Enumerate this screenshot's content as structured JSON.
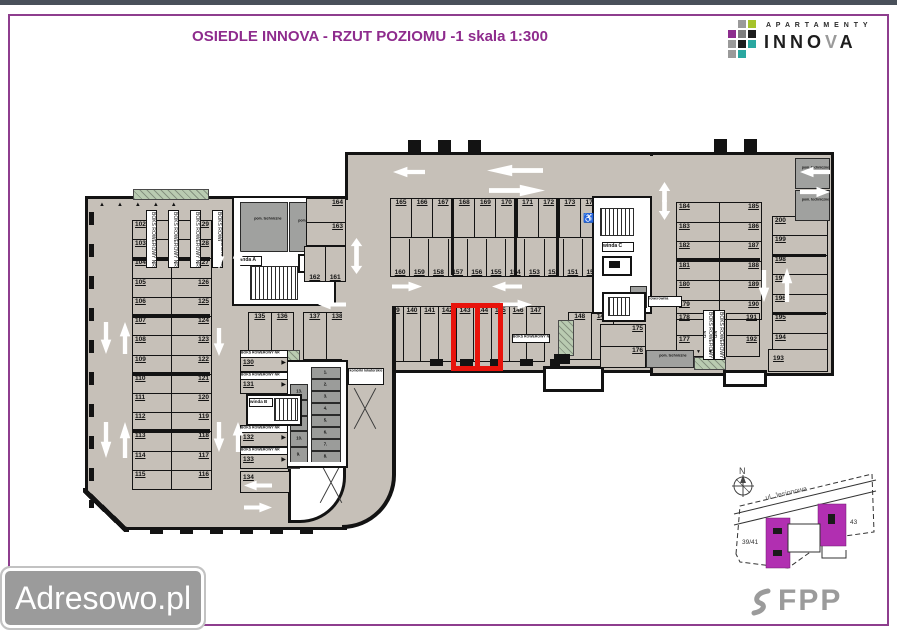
{
  "header": {
    "title": "OSIEDLE INNOVA -  RZUT POZIOMU -1 skala 1:300"
  },
  "brand": {
    "apartamenty": "A P A R T A M E N T Y",
    "innova_a": "INNO",
    "innova_b": "V",
    "innova_c": "A"
  },
  "watermark": {
    "label": "Adresowo.pl"
  },
  "footer_logo": {
    "label": "FPP"
  },
  "minimap": {
    "north_label": "N",
    "street_label": "ul. Jesionowa",
    "parcel_left": "39/41",
    "parcel_right": "43"
  },
  "plan": {
    "left_wing": {
      "col_left": [
        "102",
        "103",
        "104",
        "105",
        "106",
        "107",
        "108",
        "109",
        "110",
        "111",
        "112",
        "113",
        "114",
        "115"
      ],
      "col_right": [
        "129",
        "128",
        "127",
        "126",
        "125",
        "124",
        "123",
        "122",
        "121",
        "120",
        "119",
        "118",
        "117",
        "116"
      ]
    },
    "top_block": {
      "row_top": [
        "165",
        "166",
        "167",
        "168",
        "169",
        "170",
        "171",
        "172",
        "173",
        "174"
      ],
      "row_bottom": [
        "160",
        "159",
        "158",
        "157",
        "156",
        "155",
        "154",
        "153",
        "152",
        "151",
        "150"
      ]
    },
    "mid_block": {
      "g135": [
        "135",
        "136"
      ],
      "g137": [
        "137",
        "138"
      ],
      "g139": [
        "139",
        "140",
        "141",
        "142",
        "143",
        "144",
        "145",
        "146",
        "147"
      ],
      "g148": [
        "148",
        "149"
      ],
      "g175": [
        "175",
        "176"
      ]
    },
    "core_block": {
      "h163": [
        "164",
        "163"
      ],
      "v161": [
        "162",
        "161"
      ]
    },
    "right_wing": {
      "col_a": [
        "184",
        "183",
        "182",
        "181",
        "180",
        "179"
      ],
      "col_b": [
        "185",
        "186",
        "187",
        "188",
        "189",
        "190"
      ],
      "col_a2": [
        "178",
        "177"
      ],
      "col_b2": [
        "191",
        "192"
      ],
      "col_c": [
        "200",
        "199",
        "198",
        "197",
        "196",
        "195",
        "194"
      ],
      "wide_stall": "193"
    },
    "bike_boxes": {
      "label": "BOKS ROWEROWY NR",
      "items": [
        "130",
        "131",
        "132",
        "133"
      ],
      "last": "134"
    },
    "storage": {
      "label": "komórki lokatorskie",
      "col_left": [
        "13.",
        "12.",
        "11.",
        "10.",
        "9."
      ],
      "col_right": [
        "1.",
        "2.",
        "3.",
        "4.",
        "5.",
        "6.",
        "7.",
        "8."
      ]
    },
    "rooms": {
      "pom_techniczne": "pom. techniczne",
      "pom_tech": "pom. tech.",
      "winda_a": "winda A",
      "winda_b": "winda B",
      "winda_c": "winda C",
      "rowerownia": "rowerownia"
    },
    "icons": {
      "wheelchair": "♿",
      "triangles_row": "▲▲▲▲▲",
      "triangle_right": "▶",
      "triangles_down": "▼▼"
    },
    "highlight": {
      "stalls": "143, 144",
      "color": "#e8140c"
    }
  },
  "colors": {
    "frame": "#8e3e8e",
    "title": "#8e2b8d",
    "floor": "#c6c0b8",
    "topbar": "#49505a"
  }
}
